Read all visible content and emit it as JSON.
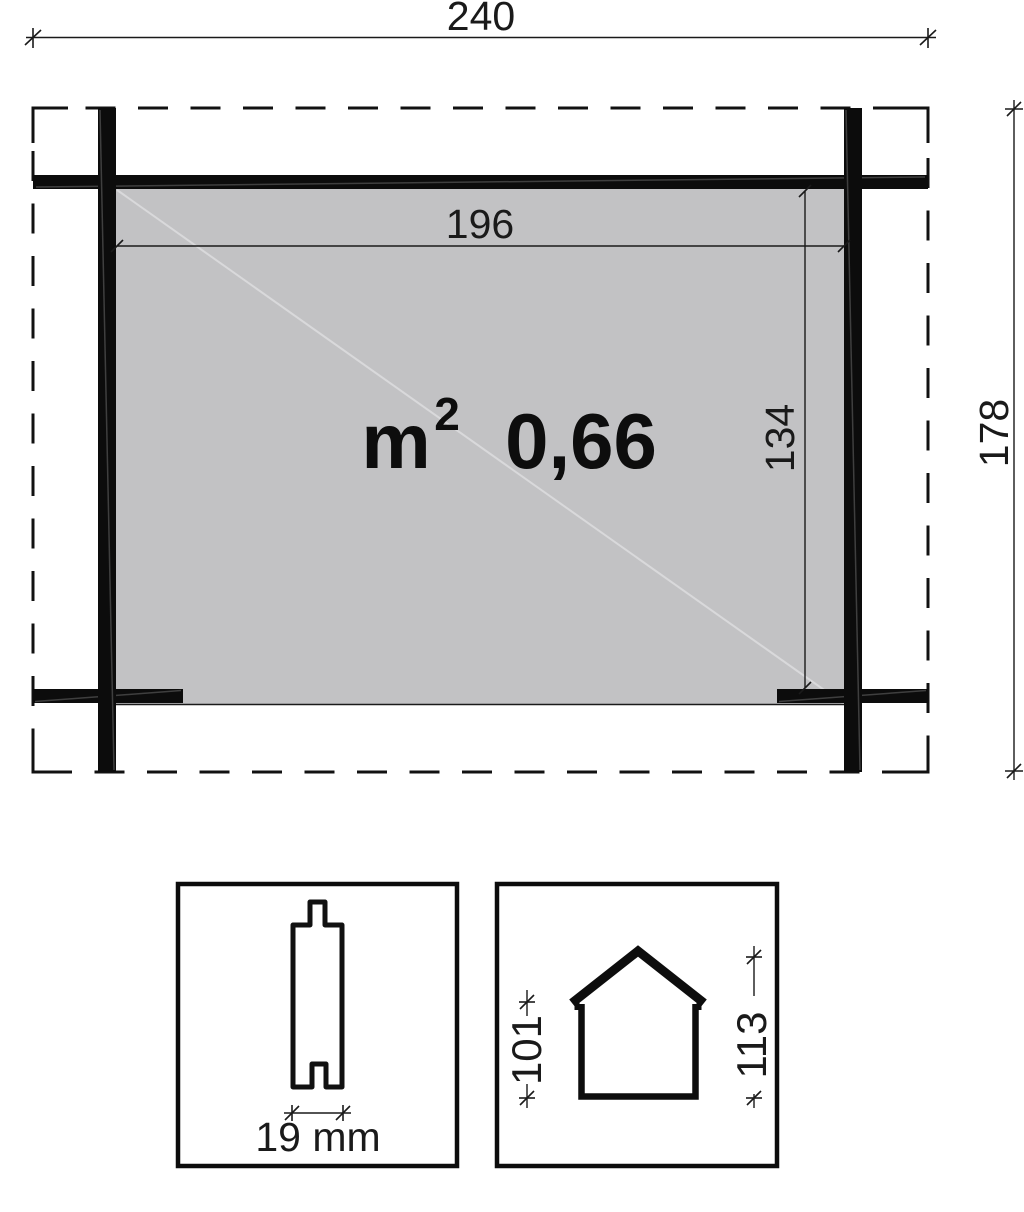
{
  "colors": {
    "ink": "#1a1a1a",
    "solid": "#0c0c0c",
    "panel": "#c2c2c4"
  },
  "plan": {
    "outer_width": "240",
    "outer_depth": "178",
    "inner_width": "196",
    "inner_depth": "134",
    "area": {
      "unit": "m",
      "exponent": "2",
      "value": "0,66"
    }
  },
  "board_detail": {
    "thickness": "19 mm"
  },
  "house_detail": {
    "wall_height": "101",
    "ridge_height": "113"
  }
}
